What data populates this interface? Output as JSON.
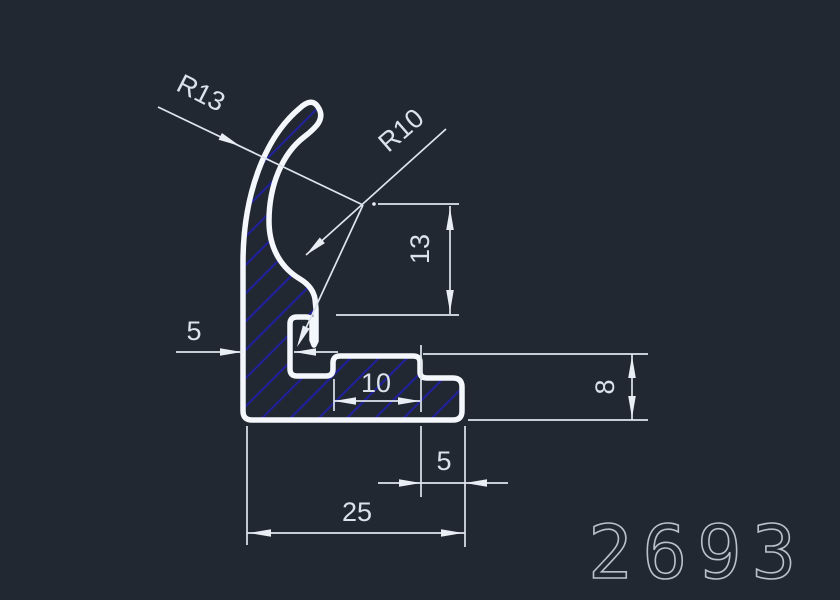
{
  "drawing": {
    "part_number": "2693",
    "dimensions": {
      "radius_outer_label": "R13",
      "radius_inner_label": "R10",
      "center_to_slot_height": "13",
      "left_wall_width": "5",
      "slot_to_step_width": "10",
      "flange_height": "8",
      "end_tab_width": "5",
      "overall_width": "25"
    },
    "colors": {
      "background": "#222831",
      "outline": "#f4f7fb",
      "hatch_blue": "#20209c",
      "dimension_lines": "#dee5ee",
      "part_number_gray": "#b9c1cc"
    }
  }
}
